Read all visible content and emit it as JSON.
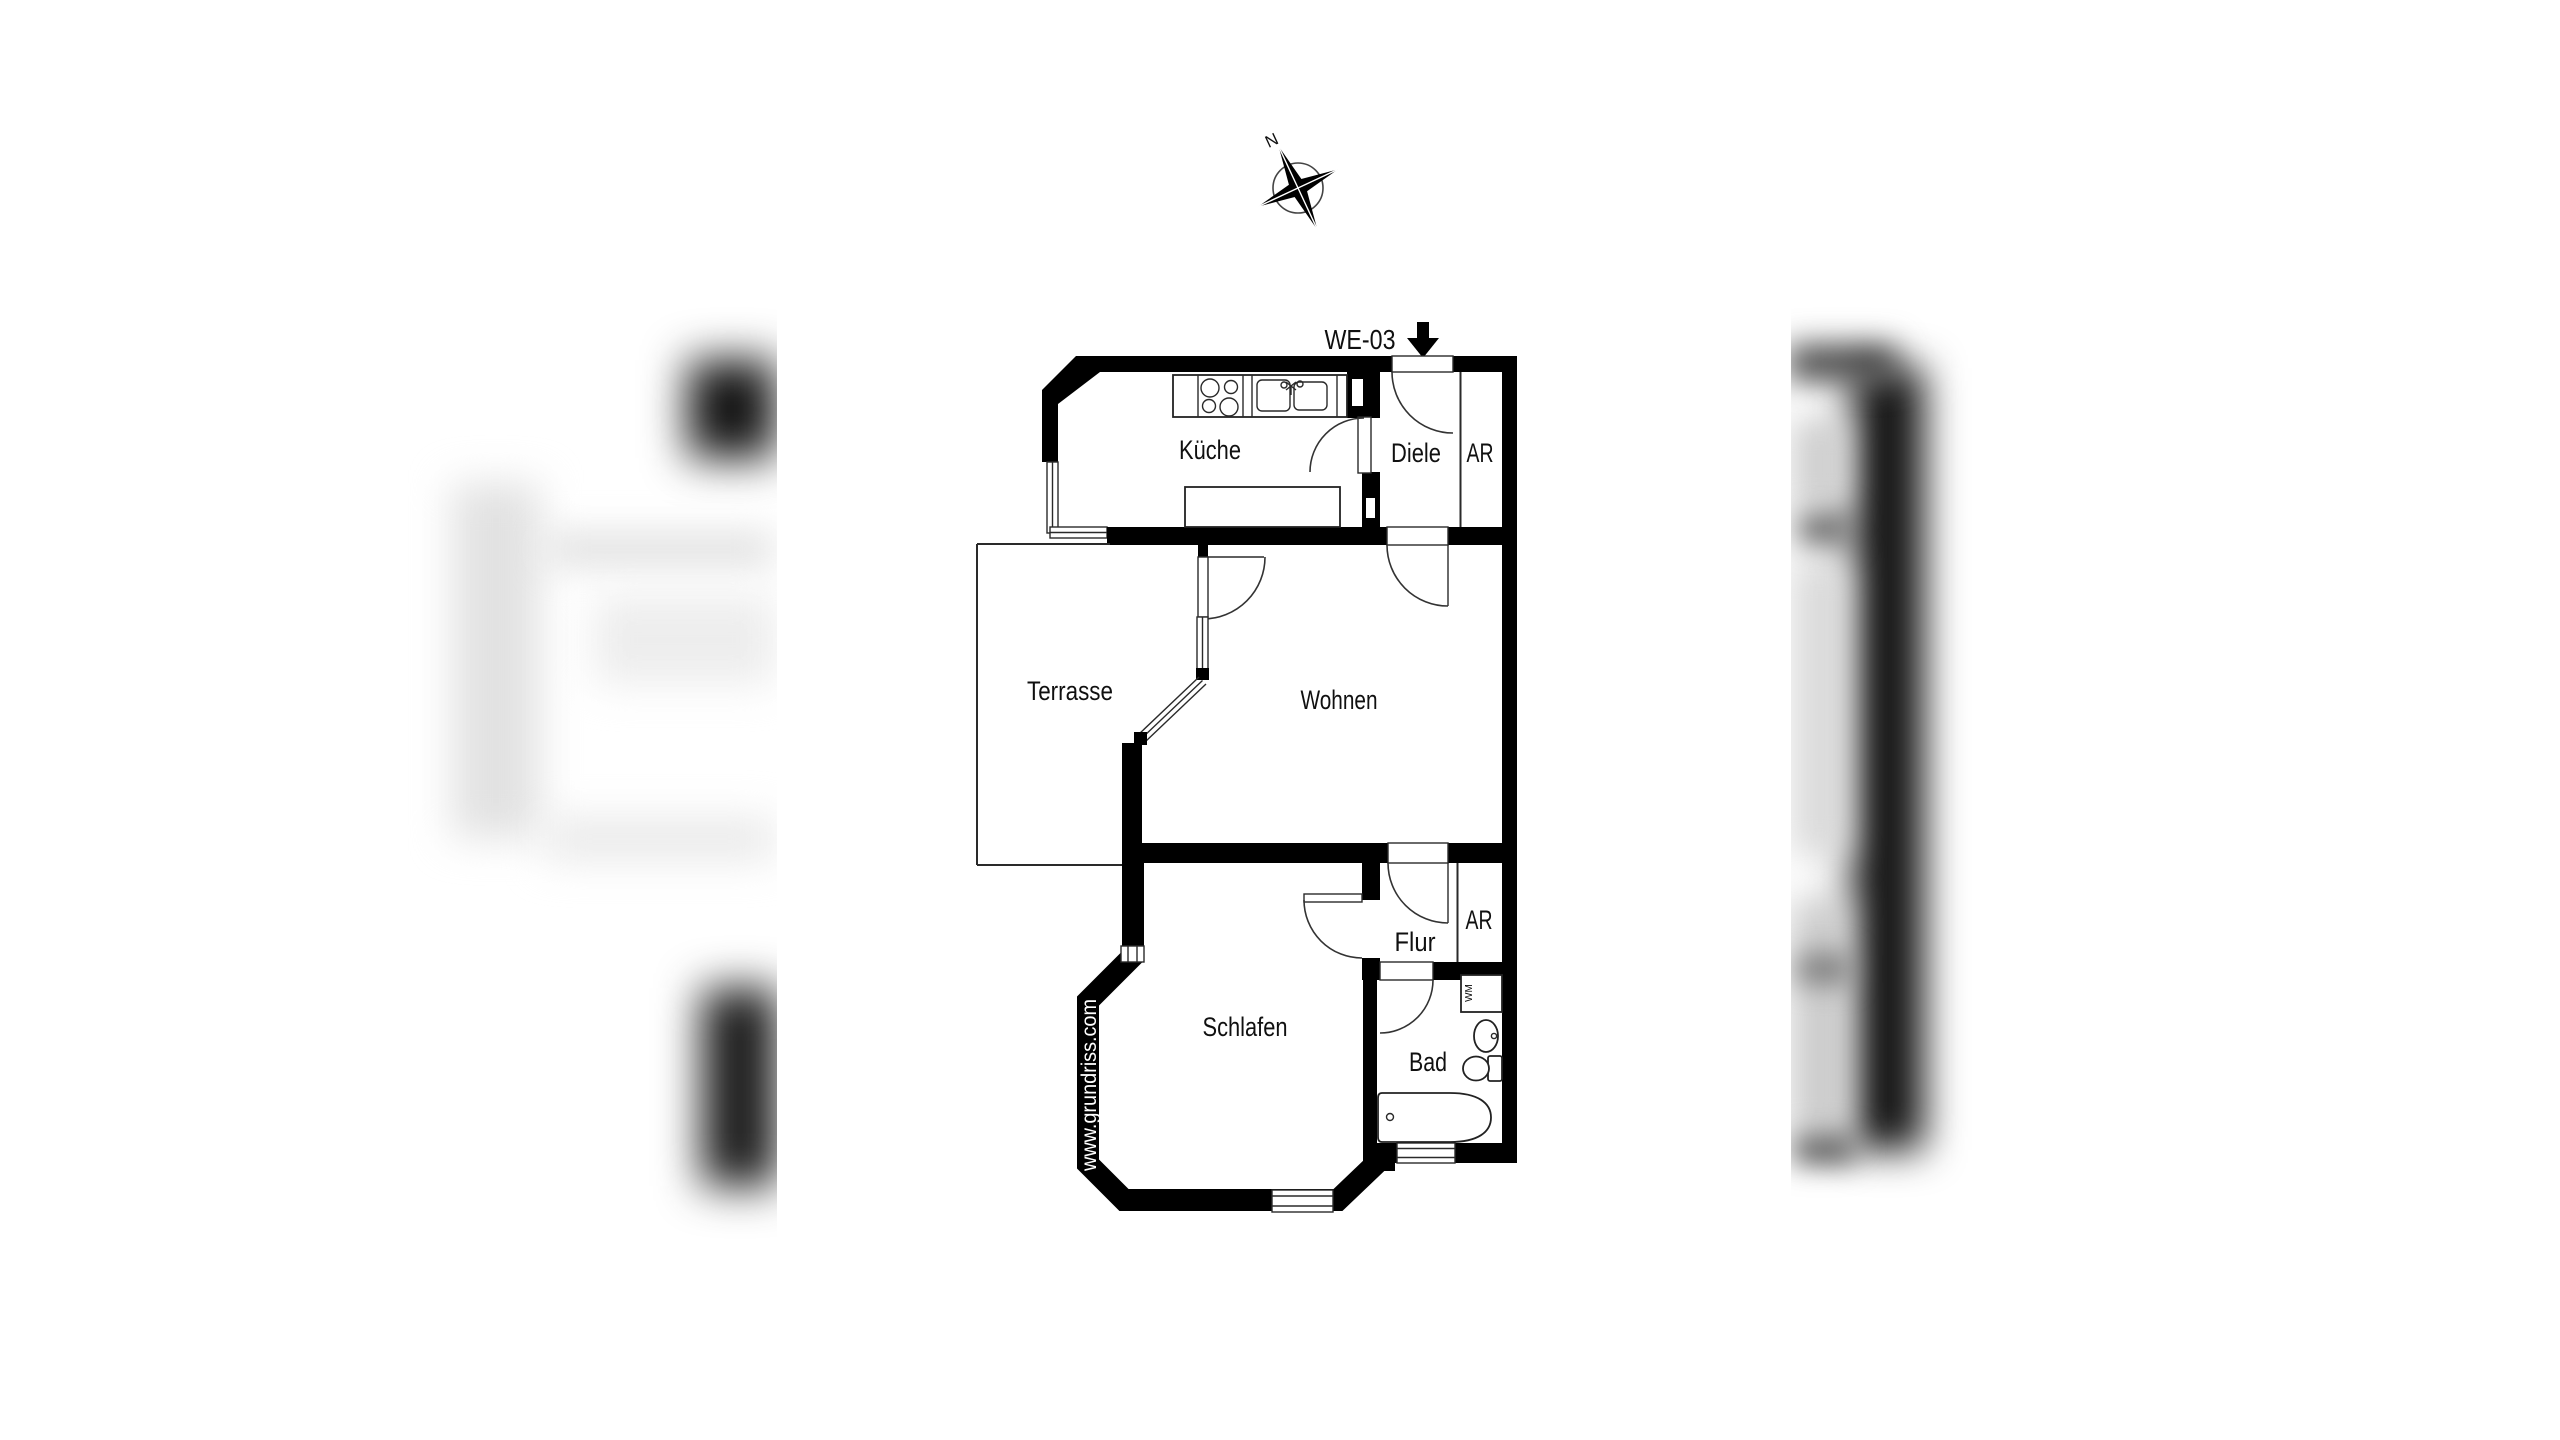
{
  "page": {
    "background": "#ffffff"
  },
  "plan": {
    "unit_label": "WE-03",
    "watermark": "www.grundriss.com",
    "compass_north_label": "N",
    "washing_machine_label": "WM",
    "rooms": {
      "kueche": "Küche",
      "diele": "Diele",
      "ar_top": "AR",
      "terrasse": "Terrasse",
      "wohnen": "Wohnen",
      "flur": "Flur",
      "ar_bottom": "AR",
      "schlafen": "Schlafen",
      "bad": "Bad"
    },
    "colors": {
      "wall": "#000000",
      "line": "#2a2a2a",
      "text": "#101010",
      "watermark_text": "#ffffff"
    }
  }
}
